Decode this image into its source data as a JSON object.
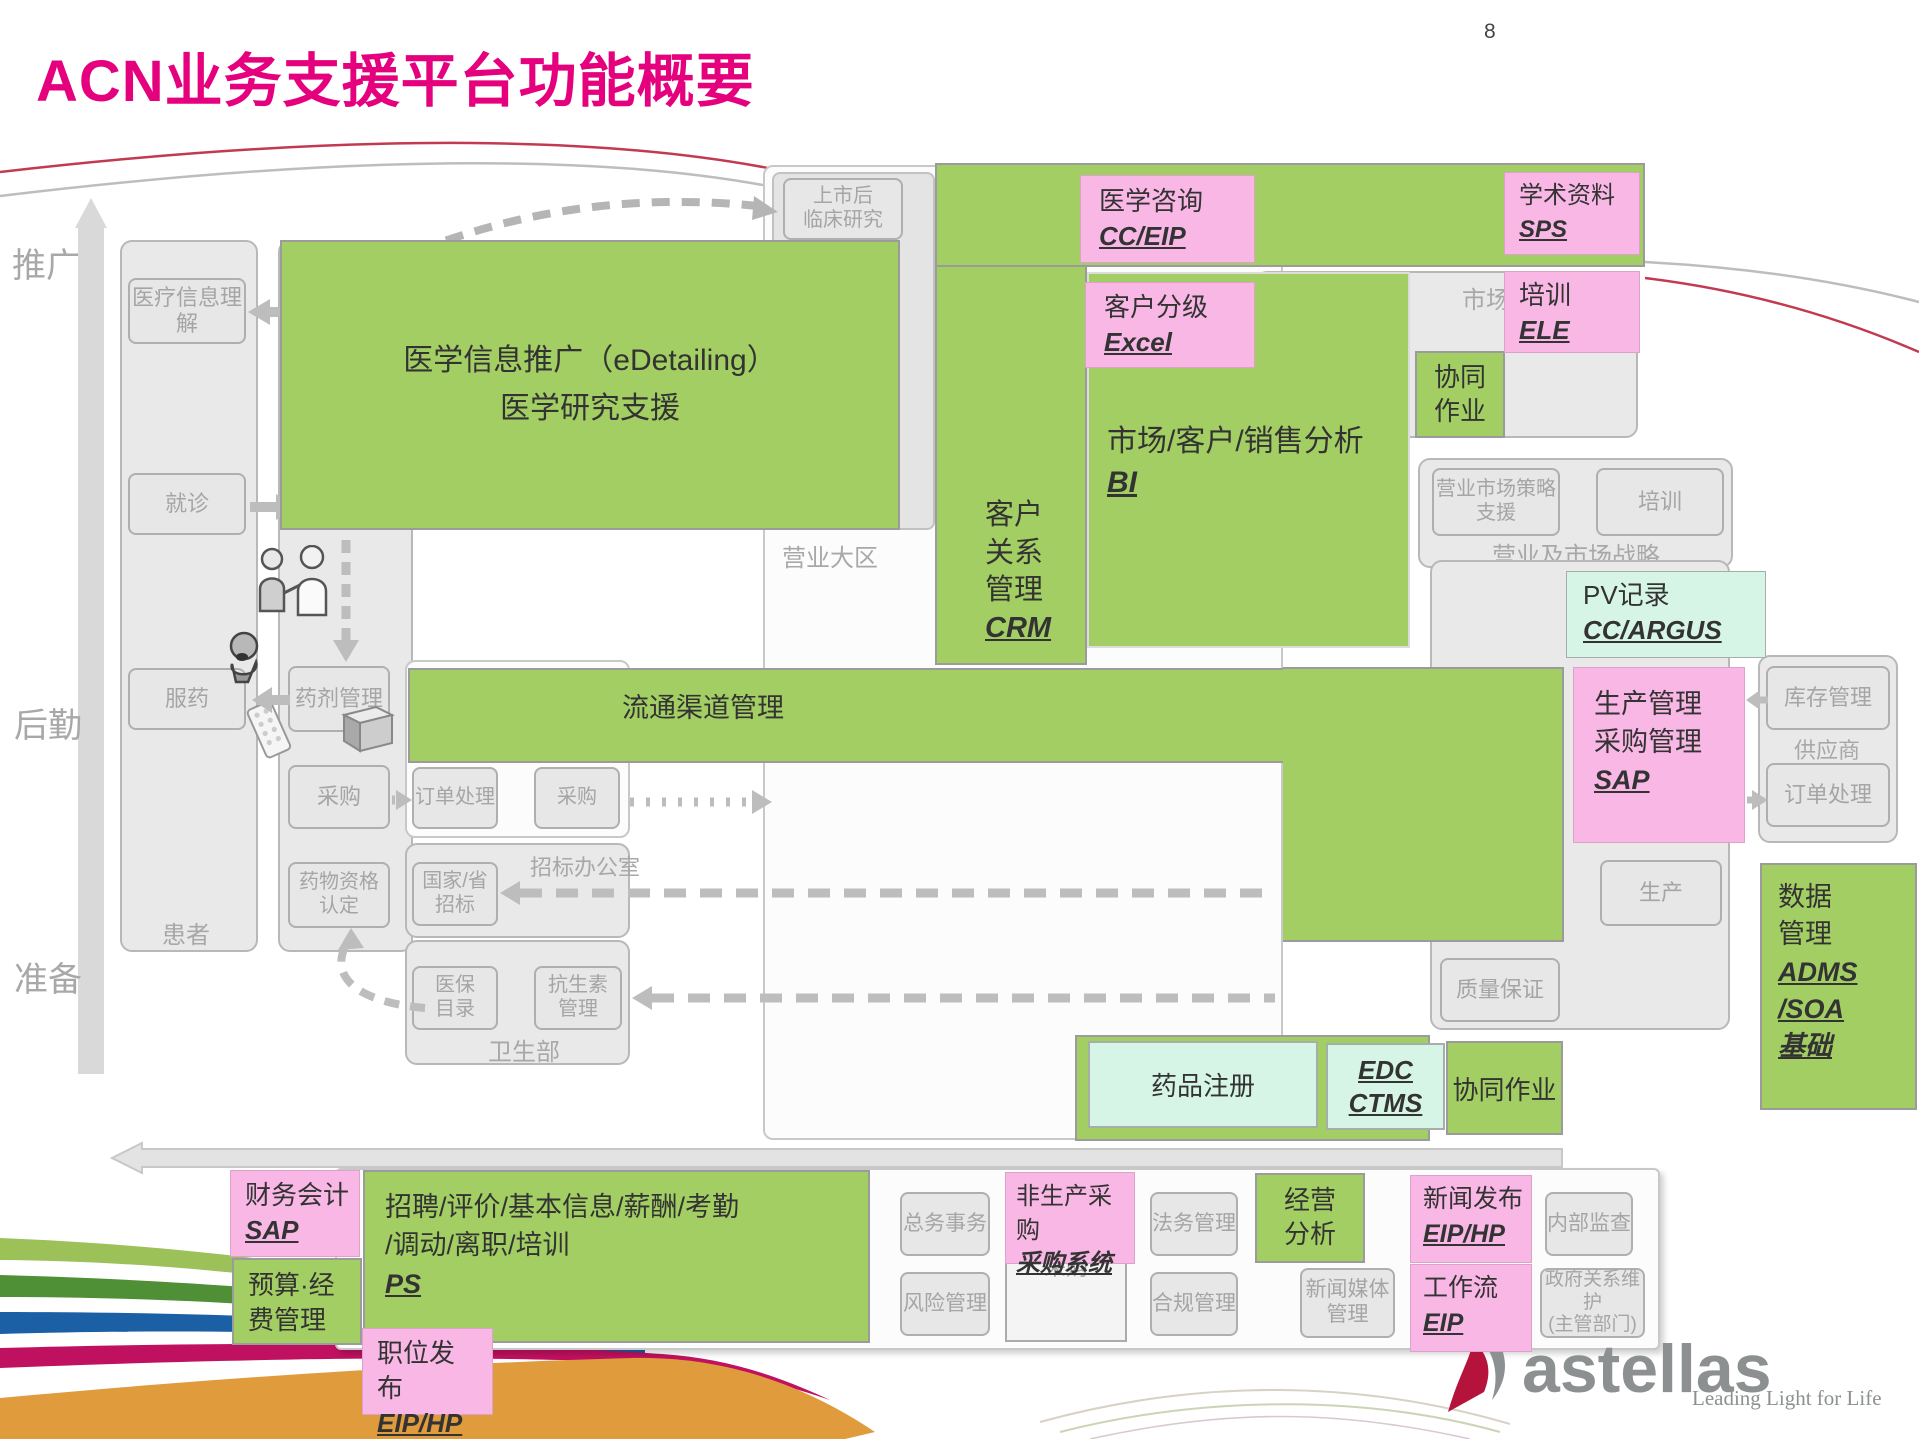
{
  "page": {
    "title": "ACN业务支援平台功能概要",
    "page_number": "8"
  },
  "colors": {
    "accent_magenta": "#E5007E",
    "green": "#A3CE63",
    "pink": "#F8B7E4",
    "mint": "#D7F5E7",
    "gray_text": "#A8A8A8",
    "brand_red": "#B5123C"
  },
  "lanes": {
    "promotion": "推广",
    "logistics": "后勤",
    "preparation": "准备"
  },
  "patient_column": {
    "label": "患者",
    "understanding": "医疗信息理解",
    "visit": "就诊",
    "medication": "服药"
  },
  "dept_column": {
    "pharmacy": "药剂管理",
    "purchase": "采购",
    "qualification": "药物资格认定"
  },
  "edetailing": {
    "line1": "医学信息推广（eDetailing）",
    "line2": "医学研究支援"
  },
  "post_market": {
    "line1": "上市后",
    "line2": "临床研究"
  },
  "sales_region": {
    "label": "营业大区"
  },
  "crm": {
    "l1": "客户",
    "l2": "关系",
    "l3": "管理",
    "code": "CRM"
  },
  "medical_consult": {
    "label": "医学咨询",
    "code": "CC/EIP"
  },
  "customer_grading": {
    "label": "客户分级",
    "code": "Excel"
  },
  "analysis_bi": {
    "label": "市场/客户/销售分析",
    "code": "BI"
  },
  "academic": {
    "label": "学术资料",
    "code": "SPS"
  },
  "training_ele": {
    "label": "培训",
    "code": "ELE"
  },
  "collab_top": {
    "l1": "协同",
    "l2": "作业"
  },
  "market_container": {
    "label": "市场"
  },
  "strategy": {
    "support": "营业市场策略支援",
    "training": "培训",
    "label": "营业及市场战略"
  },
  "pv": {
    "label": "PV记录",
    "code": "CC/ARGUS"
  },
  "distribution": {
    "label": "流通渠道管理"
  },
  "order_container": {
    "order": "订单处理",
    "purchase": "采购"
  },
  "bidding": {
    "label": "招标办公室",
    "national_l1": "国家/省",
    "national_l2": "招标"
  },
  "health_ministry": {
    "label": "卫生部",
    "insurance_l1": "医保",
    "insurance_l2": "目录",
    "antibiotic_l1": "抗生素",
    "antibiotic_l2": "管理"
  },
  "sap_production": {
    "l1": "生产管理",
    "l2": "采购管理",
    "code": "SAP"
  },
  "supplier": {
    "label": "供应商",
    "inventory": "库存管理",
    "order": "订单处理"
  },
  "factory": {
    "production": "生产",
    "qa": "质量保证"
  },
  "data_mgmt": {
    "l1": "数据",
    "l2": "管理",
    "c1": "ADMS",
    "c2": "/SOA",
    "c3": "基础"
  },
  "registration": {
    "label": "药品注册"
  },
  "edc": {
    "c1": "EDC",
    "c2": "CTMS"
  },
  "collab_bottom": {
    "label": "协同作业"
  },
  "finance": {
    "label": "财务会计",
    "code": "SAP"
  },
  "budget": {
    "l1": "预算·经",
    "l2": "费管理"
  },
  "hr": {
    "l1": "招聘/评价/基本信息/薪酬/考勤",
    "l2": "/调动/离职/培训",
    "code": "PS"
  },
  "job_post": {
    "l1": "职位发",
    "l2_prefix": "布",
    "code": "EIP/HP"
  },
  "general_affairs": "总务事务",
  "risk": "风险管理",
  "nonprod_purchase": {
    "label": "非生产采购",
    "code": "采购系统"
  },
  "purchase_gray": "采购",
  "legal": "法务管理",
  "compliance": "合规管理",
  "business_analysis": {
    "l1": "经营",
    "l2": "分析"
  },
  "news_media": {
    "l1": "新闻媒体",
    "l2": "管理"
  },
  "news_release": {
    "label": "新闻发布",
    "code": "EIP/HP"
  },
  "workflow": {
    "label": "工作流",
    "code": "EIP"
  },
  "internal_audit": "内部监查",
  "gov_relations": {
    "l1": "政府关系维护",
    "l2": "(主管部门)"
  },
  "logo": {
    "brand": "astellas",
    "tagline": "Leading Light for Life"
  }
}
